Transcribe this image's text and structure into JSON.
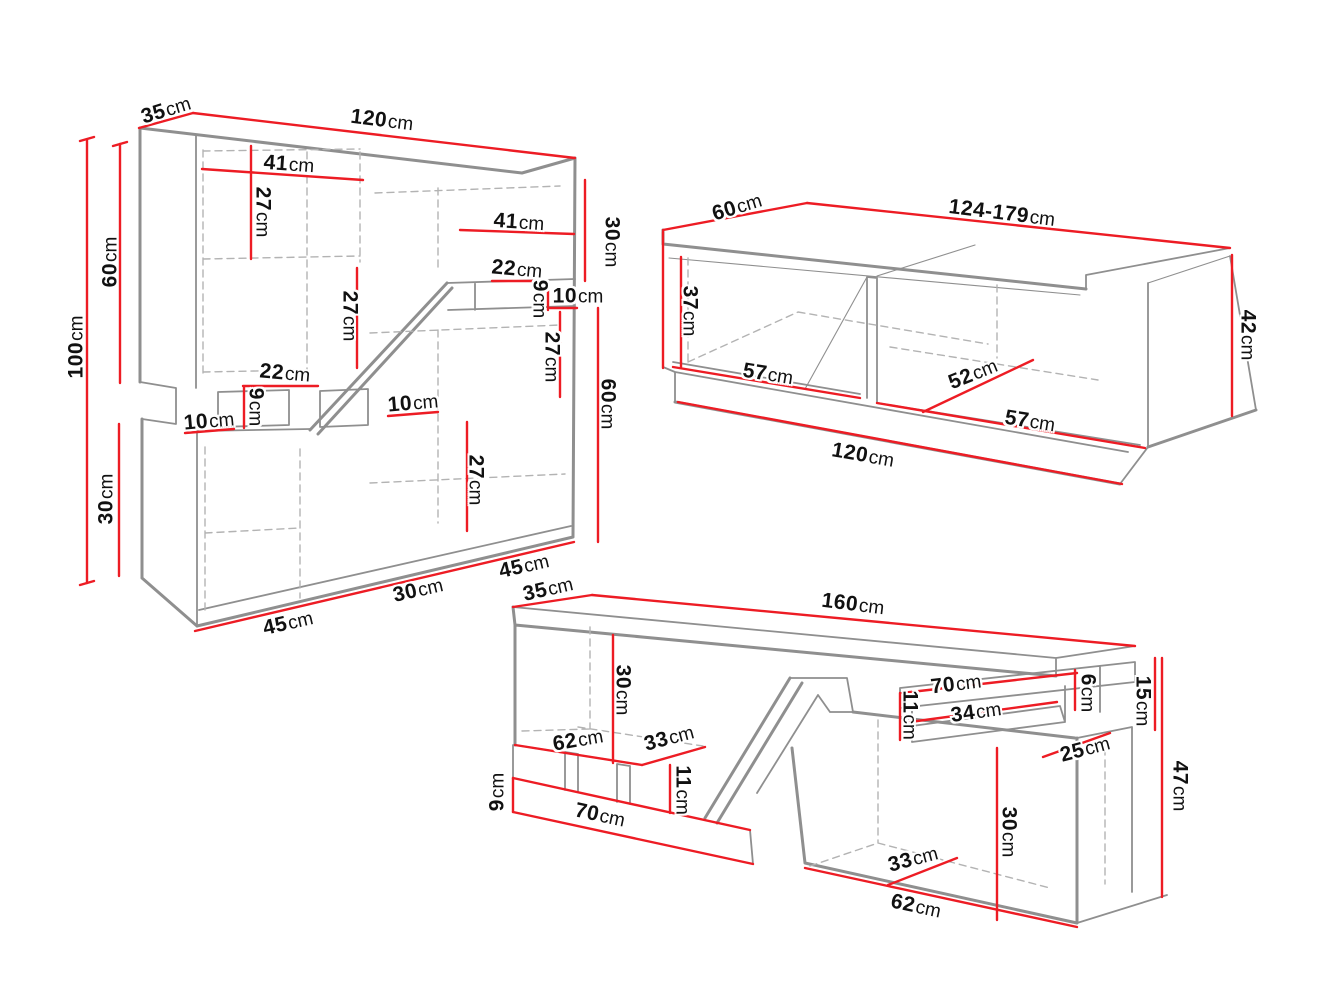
{
  "page": {
    "width": 1331,
    "height": 998,
    "background": "#ffffff"
  },
  "palette": {
    "outline": "#8f8f8f",
    "dashed": "#b3b3b3",
    "dimension": "#ed1c24",
    "text": "#111111"
  },
  "pieces": [
    {
      "id": "wall-unit",
      "overall": {
        "width": "120cm",
        "height": "100cm",
        "depth": "35cm"
      }
    },
    {
      "id": "coffee-table",
      "overall": {
        "width": "124-179cm",
        "height": "42cm",
        "depth": "60cm",
        "base_width": "120cm"
      }
    },
    {
      "id": "tv-stand",
      "overall": {
        "width": "160cm",
        "height": "47cm",
        "depth": "35cm",
        "shelf_height": "15cm"
      }
    }
  ],
  "labels": [
    {
      "piece": "wall-unit",
      "value": "35",
      "unit": "cm",
      "x": 166,
      "y": 110,
      "rot": -17
    },
    {
      "piece": "wall-unit",
      "value": "120",
      "unit": "cm",
      "x": 382,
      "y": 120,
      "rot": 7
    },
    {
      "piece": "wall-unit",
      "value": "100",
      "unit": "cm",
      "x": 76,
      "y": 347,
      "rot": -90
    },
    {
      "piece": "wall-unit",
      "value": "60",
      "unit": "cm",
      "x": 110,
      "y": 262,
      "rot": -90
    },
    {
      "piece": "wall-unit",
      "value": "30",
      "unit": "cm",
      "x": 106,
      "y": 499,
      "rot": -90
    },
    {
      "piece": "wall-unit",
      "value": "41",
      "unit": "cm",
      "x": 289,
      "y": 164,
      "rot": 4
    },
    {
      "piece": "wall-unit",
      "value": "27",
      "unit": "cm",
      "x": 263,
      "y": 212,
      "rot": 90
    },
    {
      "piece": "wall-unit",
      "value": "41",
      "unit": "cm",
      "x": 519,
      "y": 222,
      "rot": 4
    },
    {
      "piece": "wall-unit",
      "value": "30",
      "unit": "cm",
      "x": 612,
      "y": 242,
      "rot": 90
    },
    {
      "piece": "wall-unit",
      "value": "22",
      "unit": "cm",
      "x": 517,
      "y": 269,
      "rot": 5
    },
    {
      "piece": "wall-unit",
      "value": "9",
      "unit": "cm",
      "x": 540,
      "y": 299,
      "rot": 90
    },
    {
      "piece": "wall-unit",
      "value": "10",
      "unit": "cm",
      "x": 578,
      "y": 296,
      "rot": 0
    },
    {
      "piece": "wall-unit",
      "value": "27",
      "unit": "cm",
      "x": 552,
      "y": 357,
      "rot": 90
    },
    {
      "piece": "wall-unit",
      "value": "60",
      "unit": "cm",
      "x": 608,
      "y": 404,
      "rot": 90
    },
    {
      "piece": "wall-unit",
      "value": "22",
      "unit": "cm",
      "x": 285,
      "y": 373,
      "rot": 5
    },
    {
      "piece": "wall-unit",
      "value": "9",
      "unit": "cm",
      "x": 256,
      "y": 407,
      "rot": 90
    },
    {
      "piece": "wall-unit",
      "value": "10",
      "unit": "cm",
      "x": 209,
      "y": 421,
      "rot": -5
    },
    {
      "piece": "wall-unit",
      "value": "10",
      "unit": "cm",
      "x": 413,
      "y": 403,
      "rot": -5
    },
    {
      "piece": "wall-unit",
      "value": "27",
      "unit": "cm",
      "x": 350,
      "y": 316,
      "rot": 90
    },
    {
      "piece": "wall-unit",
      "value": "27",
      "unit": "cm",
      "x": 476,
      "y": 480,
      "rot": 90
    },
    {
      "piece": "wall-unit",
      "value": "45",
      "unit": "cm",
      "x": 288,
      "y": 623,
      "rot": -13
    },
    {
      "piece": "wall-unit",
      "value": "30",
      "unit": "cm",
      "x": 418,
      "y": 590,
      "rot": -13
    },
    {
      "piece": "wall-unit",
      "value": "45",
      "unit": "cm",
      "x": 524,
      "y": 566,
      "rot": -13
    },
    {
      "piece": "coffee-table",
      "value": "60",
      "unit": "cm",
      "x": 737,
      "y": 207,
      "rot": -17
    },
    {
      "piece": "coffee-table",
      "value": "124-179",
      "unit": "cm",
      "x": 1002,
      "y": 213,
      "rot": 7
    },
    {
      "piece": "coffee-table",
      "value": "37",
      "unit": "cm",
      "x": 690,
      "y": 311,
      "rot": 90
    },
    {
      "piece": "coffee-table",
      "value": "57",
      "unit": "cm",
      "x": 768,
      "y": 374,
      "rot": 9
    },
    {
      "piece": "coffee-table",
      "value": "52",
      "unit": "cm",
      "x": 973,
      "y": 374,
      "rot": -22
    },
    {
      "piece": "coffee-table",
      "value": "57",
      "unit": "cm",
      "x": 1030,
      "y": 421,
      "rot": 9
    },
    {
      "piece": "coffee-table",
      "value": "120",
      "unit": "cm",
      "x": 863,
      "y": 455,
      "rot": 10
    },
    {
      "piece": "coffee-table",
      "value": "42",
      "unit": "cm",
      "x": 1248,
      "y": 335,
      "rot": 90
    },
    {
      "piece": "tv-stand",
      "value": "35",
      "unit": "cm",
      "x": 548,
      "y": 589,
      "rot": -13
    },
    {
      "piece": "tv-stand",
      "value": "160",
      "unit": "cm",
      "x": 853,
      "y": 604,
      "rot": 7
    },
    {
      "piece": "tv-stand",
      "value": "30",
      "unit": "cm",
      "x": 623,
      "y": 690,
      "rot": 90
    },
    {
      "piece": "tv-stand",
      "value": "62",
      "unit": "cm",
      "x": 578,
      "y": 740,
      "rot": -10
    },
    {
      "piece": "tv-stand",
      "value": "33",
      "unit": "cm",
      "x": 669,
      "y": 738,
      "rot": -15
    },
    {
      "piece": "tv-stand",
      "value": "11",
      "unit": "cm",
      "x": 683,
      "y": 790,
      "rot": 90
    },
    {
      "piece": "tv-stand",
      "value": "9",
      "unit": "cm",
      "x": 497,
      "y": 792,
      "rot": -90
    },
    {
      "piece": "tv-stand",
      "value": "70",
      "unit": "cm",
      "x": 600,
      "y": 815,
      "rot": 12
    },
    {
      "piece": "tv-stand",
      "value": "70",
      "unit": "cm",
      "x": 956,
      "y": 684,
      "rot": -7
    },
    {
      "piece": "tv-stand",
      "value": "34",
      "unit": "cm",
      "x": 976,
      "y": 712,
      "rot": -8
    },
    {
      "piece": "tv-stand",
      "value": "11",
      "unit": "cm",
      "x": 910,
      "y": 715,
      "rot": 90
    },
    {
      "piece": "tv-stand",
      "value": "6",
      "unit": "cm",
      "x": 1088,
      "y": 693,
      "rot": 90
    },
    {
      "piece": "tv-stand",
      "value": "15",
      "unit": "cm",
      "x": 1143,
      "y": 701,
      "rot": 90
    },
    {
      "piece": "tv-stand",
      "value": "25",
      "unit": "cm",
      "x": 1085,
      "y": 749,
      "rot": -15
    },
    {
      "piece": "tv-stand",
      "value": "47",
      "unit": "cm",
      "x": 1180,
      "y": 786,
      "rot": 90
    },
    {
      "piece": "tv-stand",
      "value": "30",
      "unit": "cm",
      "x": 1009,
      "y": 832,
      "rot": 90
    },
    {
      "piece": "tv-stand",
      "value": "33",
      "unit": "cm",
      "x": 913,
      "y": 859,
      "rot": -15
    },
    {
      "piece": "tv-stand",
      "value": "62",
      "unit": "cm",
      "x": 916,
      "y": 906,
      "rot": 12
    }
  ],
  "dimension_lines": [
    {
      "piece": "wall-unit",
      "x1": 139,
      "y1": 128,
      "x2": 193,
      "y2": 113
    },
    {
      "piece": "wall-unit",
      "x1": 193,
      "y1": 113,
      "x2": 575,
      "y2": 158
    },
    {
      "piece": "wall-unit",
      "x1": 87,
      "y1": 140,
      "x2": 87,
      "y2": 583
    },
    {
      "piece": "wall-unit",
      "x1": 80,
      "y1": 141,
      "x2": 94,
      "y2": 137
    },
    {
      "piece": "wall-unit",
      "x1": 80,
      "y1": 585,
      "x2": 94,
      "y2": 581
    },
    {
      "piece": "wall-unit",
      "x1": 120,
      "y1": 144,
      "x2": 120,
      "y2": 383
    },
    {
      "piece": "wall-unit",
      "x1": 113,
      "y1": 146,
      "x2": 127,
      "y2": 142
    },
    {
      "piece": "wall-unit",
      "x1": 119,
      "y1": 424,
      "x2": 119,
      "y2": 576
    },
    {
      "piece": "wall-unit",
      "x1": 202,
      "y1": 169,
      "x2": 363,
      "y2": 180
    },
    {
      "piece": "wall-unit",
      "x1": 251,
      "y1": 146,
      "x2": 251,
      "y2": 259
    },
    {
      "piece": "wall-unit",
      "x1": 460,
      "y1": 230,
      "x2": 574,
      "y2": 234
    },
    {
      "piece": "wall-unit",
      "x1": 585,
      "y1": 180,
      "x2": 585,
      "y2": 281
    },
    {
      "piece": "wall-unit",
      "x1": 492,
      "y1": 281,
      "x2": 548,
      "y2": 281
    },
    {
      "piece": "wall-unit",
      "x1": 548,
      "y1": 281,
      "x2": 548,
      "y2": 310
    },
    {
      "piece": "wall-unit",
      "x1": 550,
      "y1": 308,
      "x2": 577,
      "y2": 308
    },
    {
      "piece": "wall-unit",
      "x1": 560,
      "y1": 312,
      "x2": 560,
      "y2": 397
    },
    {
      "piece": "wall-unit",
      "x1": 598,
      "y1": 308,
      "x2": 598,
      "y2": 542
    },
    {
      "piece": "wall-unit",
      "x1": 243,
      "y1": 386,
      "x2": 318,
      "y2": 386
    },
    {
      "piece": "wall-unit",
      "x1": 244,
      "y1": 387,
      "x2": 244,
      "y2": 428
    },
    {
      "piece": "wall-unit",
      "x1": 185,
      "y1": 433,
      "x2": 234,
      "y2": 429
    },
    {
      "piece": "wall-unit",
      "x1": 388,
      "y1": 416,
      "x2": 438,
      "y2": 412
    },
    {
      "piece": "wall-unit",
      "x1": 357,
      "y1": 268,
      "x2": 357,
      "y2": 368
    },
    {
      "piece": "wall-unit",
      "x1": 467,
      "y1": 422,
      "x2": 467,
      "y2": 531
    },
    {
      "piece": "wall-unit",
      "x1": 195,
      "y1": 631,
      "x2": 574,
      "y2": 542
    },
    {
      "piece": "coffee-table",
      "x1": 663,
      "y1": 230,
      "x2": 807,
      "y2": 203
    },
    {
      "piece": "coffee-table",
      "x1": 807,
      "y1": 203,
      "x2": 1230,
      "y2": 248
    },
    {
      "piece": "coffee-table",
      "x1": 663,
      "y1": 232,
      "x2": 663,
      "y2": 368
    },
    {
      "piece": "coffee-table",
      "x1": 681,
      "y1": 257,
      "x2": 681,
      "y2": 367
    },
    {
      "piece": "coffee-table",
      "x1": 673,
      "y1": 367,
      "x2": 860,
      "y2": 398
    },
    {
      "piece": "coffee-table",
      "x1": 923,
      "y1": 412,
      "x2": 1033,
      "y2": 360
    },
    {
      "piece": "coffee-table",
      "x1": 877,
      "y1": 403,
      "x2": 1145,
      "y2": 448
    },
    {
      "piece": "coffee-table",
      "x1": 678,
      "y1": 402,
      "x2": 1122,
      "y2": 484
    },
    {
      "piece": "coffee-table",
      "x1": 1232,
      "y1": 255,
      "x2": 1232,
      "y2": 416
    },
    {
      "piece": "tv-stand",
      "x1": 513,
      "y1": 607,
      "x2": 592,
      "y2": 595
    },
    {
      "piece": "tv-stand",
      "x1": 592,
      "y1": 595,
      "x2": 1135,
      "y2": 646
    },
    {
      "piece": "tv-stand",
      "x1": 613,
      "y1": 635,
      "x2": 613,
      "y2": 763
    },
    {
      "piece": "tv-stand",
      "x1": 515,
      "y1": 745,
      "x2": 642,
      "y2": 765
    },
    {
      "piece": "tv-stand",
      "x1": 642,
      "y1": 765,
      "x2": 705,
      "y2": 747
    },
    {
      "piece": "tv-stand",
      "x1": 670,
      "y1": 765,
      "x2": 670,
      "y2": 813
    },
    {
      "piece": "tv-stand",
      "x1": 513,
      "y1": 778,
      "x2": 513,
      "y2": 812
    },
    {
      "piece": "tv-stand",
      "x1": 513,
      "y1": 778,
      "x2": 750,
      "y2": 830
    },
    {
      "piece": "tv-stand",
      "x1": 513,
      "y1": 812,
      "x2": 753,
      "y2": 864
    },
    {
      "piece": "tv-stand",
      "x1": 902,
      "y1": 693,
      "x2": 1077,
      "y2": 673
    },
    {
      "piece": "tv-stand",
      "x1": 910,
      "y1": 722,
      "x2": 1057,
      "y2": 702
    },
    {
      "piece": "tv-stand",
      "x1": 900,
      "y1": 693,
      "x2": 900,
      "y2": 740
    },
    {
      "piece": "tv-stand",
      "x1": 1075,
      "y1": 670,
      "x2": 1075,
      "y2": 710
    },
    {
      "piece": "tv-stand",
      "x1": 1155,
      "y1": 658,
      "x2": 1155,
      "y2": 730
    },
    {
      "piece": "tv-stand",
      "x1": 1043,
      "y1": 757,
      "x2": 1110,
      "y2": 733
    },
    {
      "piece": "tv-stand",
      "x1": 1162,
      "y1": 658,
      "x2": 1162,
      "y2": 897
    },
    {
      "piece": "tv-stand",
      "x1": 997,
      "y1": 748,
      "x2": 997,
      "y2": 920
    },
    {
      "piece": "tv-stand",
      "x1": 888,
      "y1": 885,
      "x2": 957,
      "y2": 858
    },
    {
      "piece": "tv-stand",
      "x1": 805,
      "y1": 868,
      "x2": 1077,
      "y2": 927
    }
  ]
}
